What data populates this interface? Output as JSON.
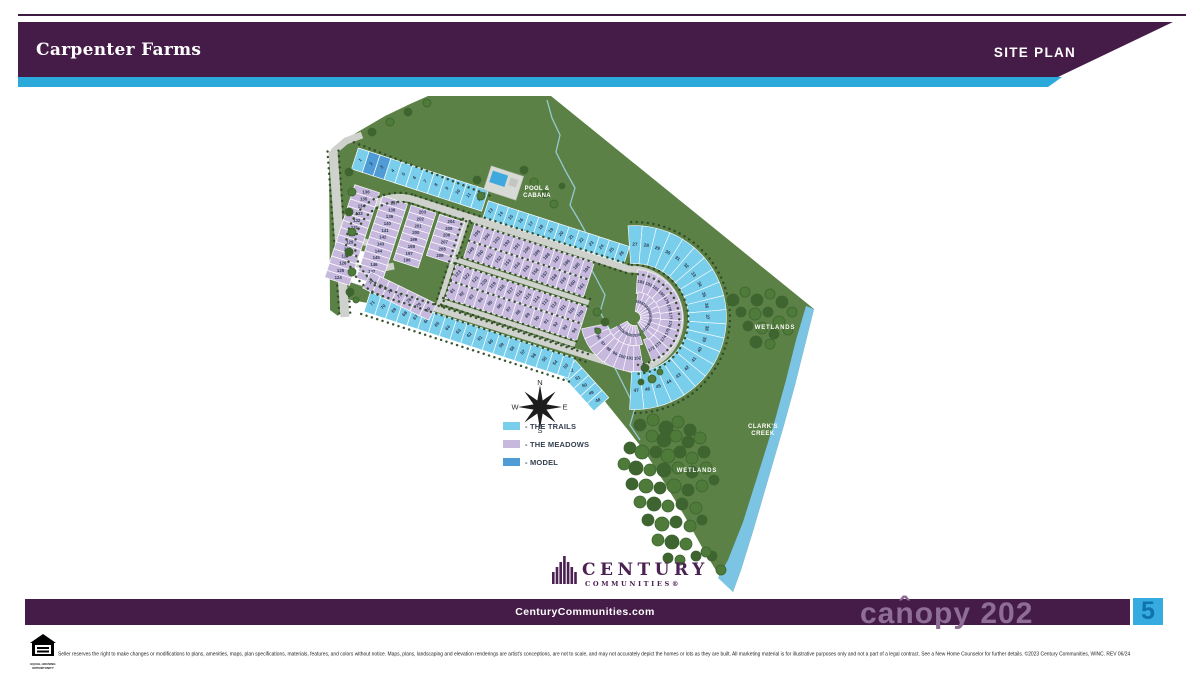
{
  "header": {
    "title": "Carpenter Farms",
    "badge": "SITE PLAN"
  },
  "legend": {
    "items": [
      {
        "key": "trails",
        "label": "- THE TRAILS"
      },
      {
        "key": "meadows",
        "label": "- THE MEADOWS"
      },
      {
        "key": "model",
        "label": "- MODEL"
      }
    ]
  },
  "colors": {
    "banner": "#451C48",
    "teal": "#2BA9DB",
    "trails": "#79CEEC",
    "meadows": "#C7B8DD",
    "model": "#4E9BD6",
    "green": "#5C8146",
    "road": "#CFD1CD",
    "creek": "#7BC4E4",
    "treeDark": "#3E6430",
    "treeMid": "#4E7A3A",
    "dots": "#2F4A26",
    "number": "#2E3B52",
    "logo": "#4A2152"
  },
  "map_labels": {
    "pool": [
      "POOL &",
      "CABANA"
    ],
    "wetlands_right": "WETLANDS",
    "wetlands_bottom": "WETLANDS",
    "clarks_creek": [
      "CLARK'S",
      "CREEK"
    ],
    "compass": {
      "n": "N",
      "e": "E",
      "s": "S",
      "w": "W"
    }
  },
  "lots": {
    "trails_top": [
      1,
      2,
      3,
      4,
      5,
      6,
      7,
      8,
      9,
      10,
      11,
      12
    ],
    "trails_top_model": [
      2,
      3
    ],
    "trails_upper": [
      13,
      14,
      15,
      16,
      17,
      18,
      19,
      20,
      21,
      22,
      23,
      24,
      25,
      26
    ],
    "trails_cap": [
      27,
      28,
      29,
      30,
      31,
      32,
      33,
      34,
      35,
      36,
      37,
      38,
      39,
      40,
      41,
      42,
      43,
      44,
      45,
      46,
      47
    ],
    "trails_southeast": [
      52,
      51,
      50,
      49,
      48
    ],
    "trails_bottom": [
      71,
      70,
      69,
      68,
      67,
      66,
      65,
      64,
      63,
      62,
      61,
      60,
      59,
      58,
      57,
      56,
      55,
      54,
      53
    ],
    "meadows_west_col": [
      136,
      135,
      134,
      133,
      132,
      131,
      130,
      129,
      128,
      127,
      126,
      125,
      124
    ],
    "meadows_col2": [
      137,
      138,
      139,
      140,
      141,
      142,
      143,
      144,
      145,
      146,
      147,
      148
    ],
    "meadows_col3": [
      203,
      202,
      201,
      200,
      199,
      198,
      197,
      196
    ],
    "meadows_col4": [
      204,
      205,
      206,
      207,
      208,
      209
    ],
    "meadows_row1": [
      195,
      194,
      193,
      192,
      191,
      190,
      189,
      188,
      187,
      186,
      185,
      184
    ],
    "meadows_row2": [
      149,
      150,
      151,
      152,
      153,
      154,
      155,
      156,
      157,
      158,
      159,
      160,
      161
    ],
    "meadows_row3": [
      123,
      122,
      121,
      120,
      119,
      118,
      117,
      116,
      115,
      114,
      113,
      112,
      111,
      110,
      109
    ],
    "meadows_row4": [
      81,
      82,
      83,
      84,
      85,
      86,
      87,
      88,
      89,
      90,
      91,
      92,
      93,
      94
    ],
    "meadows_southwest": [
      74,
      75,
      76,
      77,
      78,
      79,
      80
    ],
    "meadows_cap_outer": [
      183,
      182,
      181,
      180,
      179,
      178,
      177,
      176,
      175,
      174,
      173,
      172
    ],
    "meadows_cap_south": [
      95,
      96,
      97,
      98,
      99,
      100,
      101,
      102
    ],
    "meadows_cap_south_inner": [
      103,
      104,
      105,
      106,
      107,
      108
    ],
    "meadows_cap_inner": [
      162,
      163,
      164,
      165,
      166,
      167,
      168,
      169,
      170,
      171
    ]
  },
  "logo": {
    "line1": "CENTURY",
    "line2": "COMMUNITIES®"
  },
  "footer": {
    "url": "CenturyCommunities.com",
    "watermark": "can̂opy 202",
    "watermark_square": "5",
    "equal_housing": [
      "EQUAL HOUSING",
      "OPPORTUNITY"
    ],
    "disclaimer": "Seller reserves the right to make changes or modifications to plans, amenities, maps, plan specifications, materials, features, and colors without notice. Maps, plans, landscaping and elevation renderings are artist's conceptions, are not to scale, and may not accurately depict the homes or lots as they are built. All marketing material is for illustrative purposes only and not a part of a legal contract. See a New Home Counselor for further details. ©2023 Century Communities, WINC. REV 06/24"
  }
}
